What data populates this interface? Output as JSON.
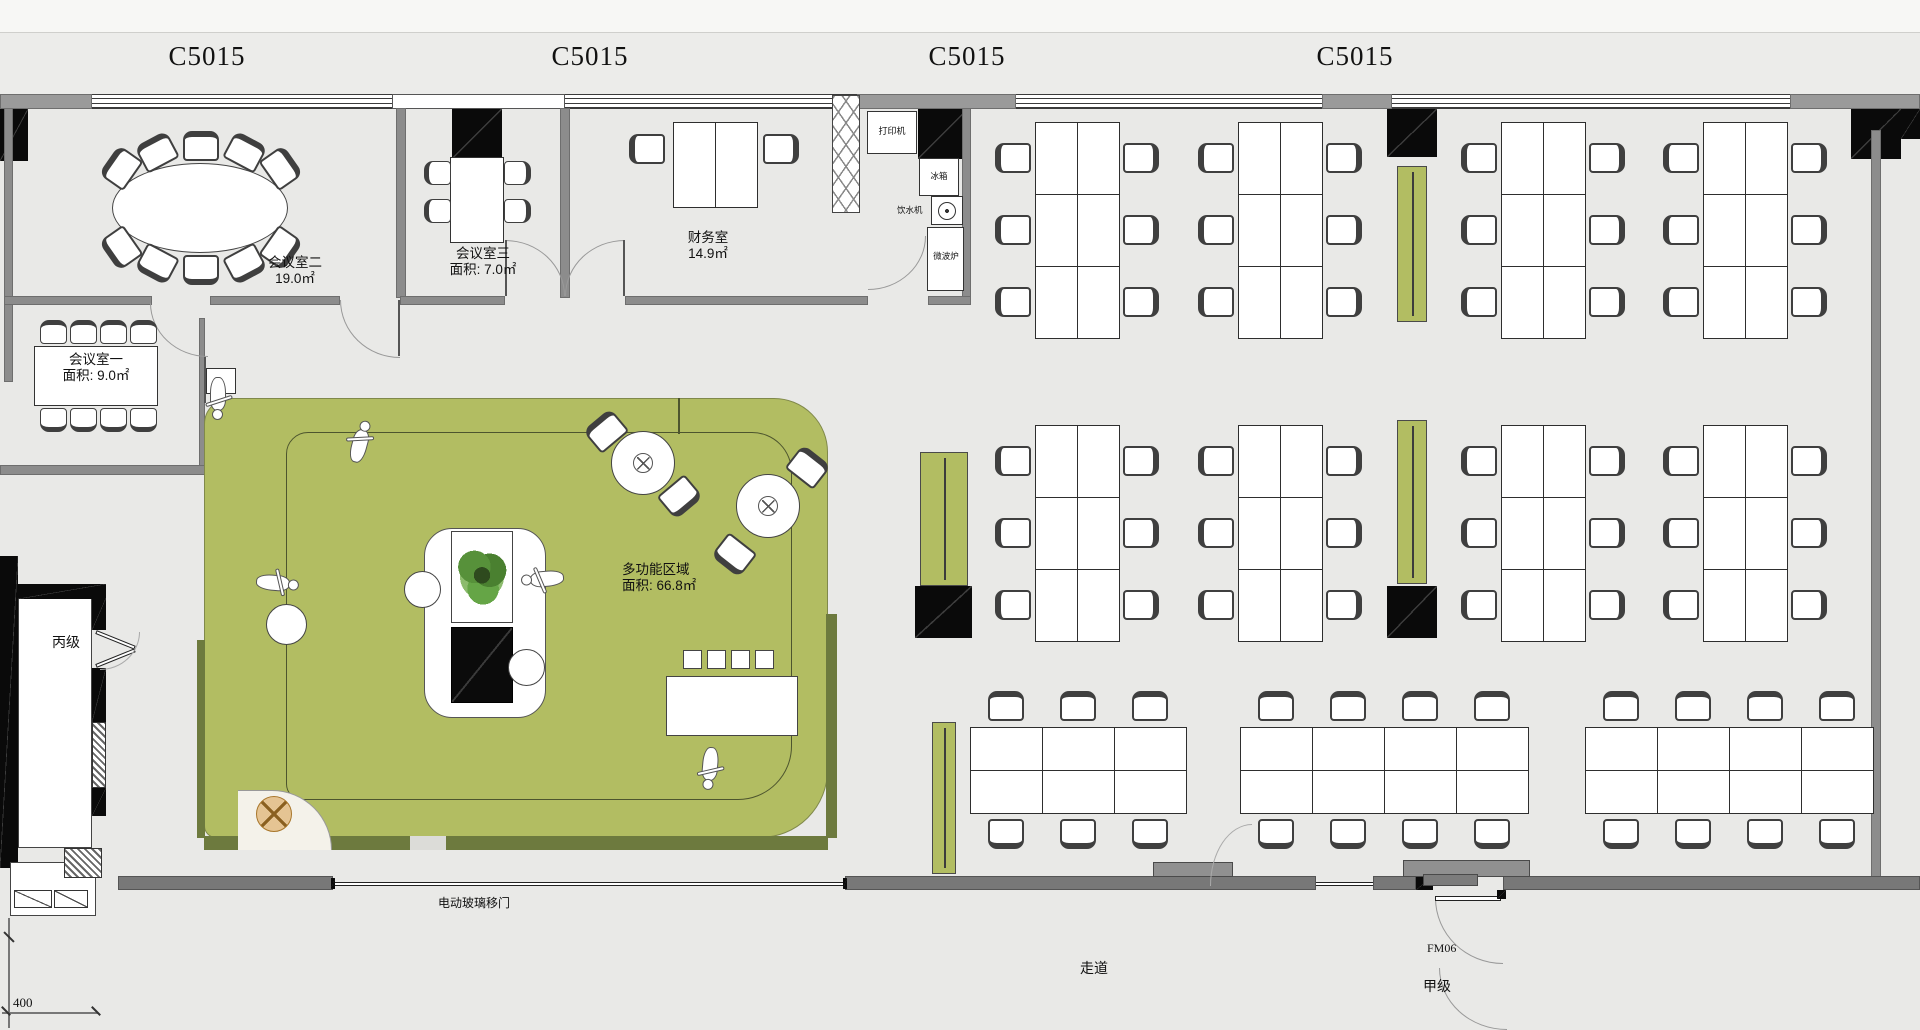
{
  "plan": {
    "unit_labels": [
      "C5015",
      "C5015",
      "C5015",
      "C5015"
    ]
  },
  "rooms": {
    "meeting2": {
      "name": "会议室二",
      "area": "19.0㎡"
    },
    "meeting3": {
      "name": "会议室三",
      "area": "面积: 7.0㎡"
    },
    "finance": {
      "name": "财务室",
      "area": "14.9㎡"
    },
    "meeting1": {
      "name": "会议室一",
      "area": "面积: 9.0㎡"
    },
    "multifunction": {
      "name": "多功能区域",
      "area": "面积: 66.8㎡"
    }
  },
  "equipment": {
    "printer": "打印机",
    "fridge": "冰箱",
    "water_dispenser": "饮水机",
    "microwave": "微波炉"
  },
  "doors": {
    "sliding_door": "电动玻璃移门",
    "fire_door_c": "丙级",
    "fire_door_a": "甲级",
    "door_code": "FM06"
  },
  "labels": {
    "corridor": "走道",
    "dimension": "400"
  },
  "colors": {
    "zone_green": "#b2bd62",
    "dark_olive": "#6d7a3e",
    "floor": "#e9e9e7",
    "wall_gray": "#8c8c8c",
    "column_black": "#0a0a0a"
  }
}
